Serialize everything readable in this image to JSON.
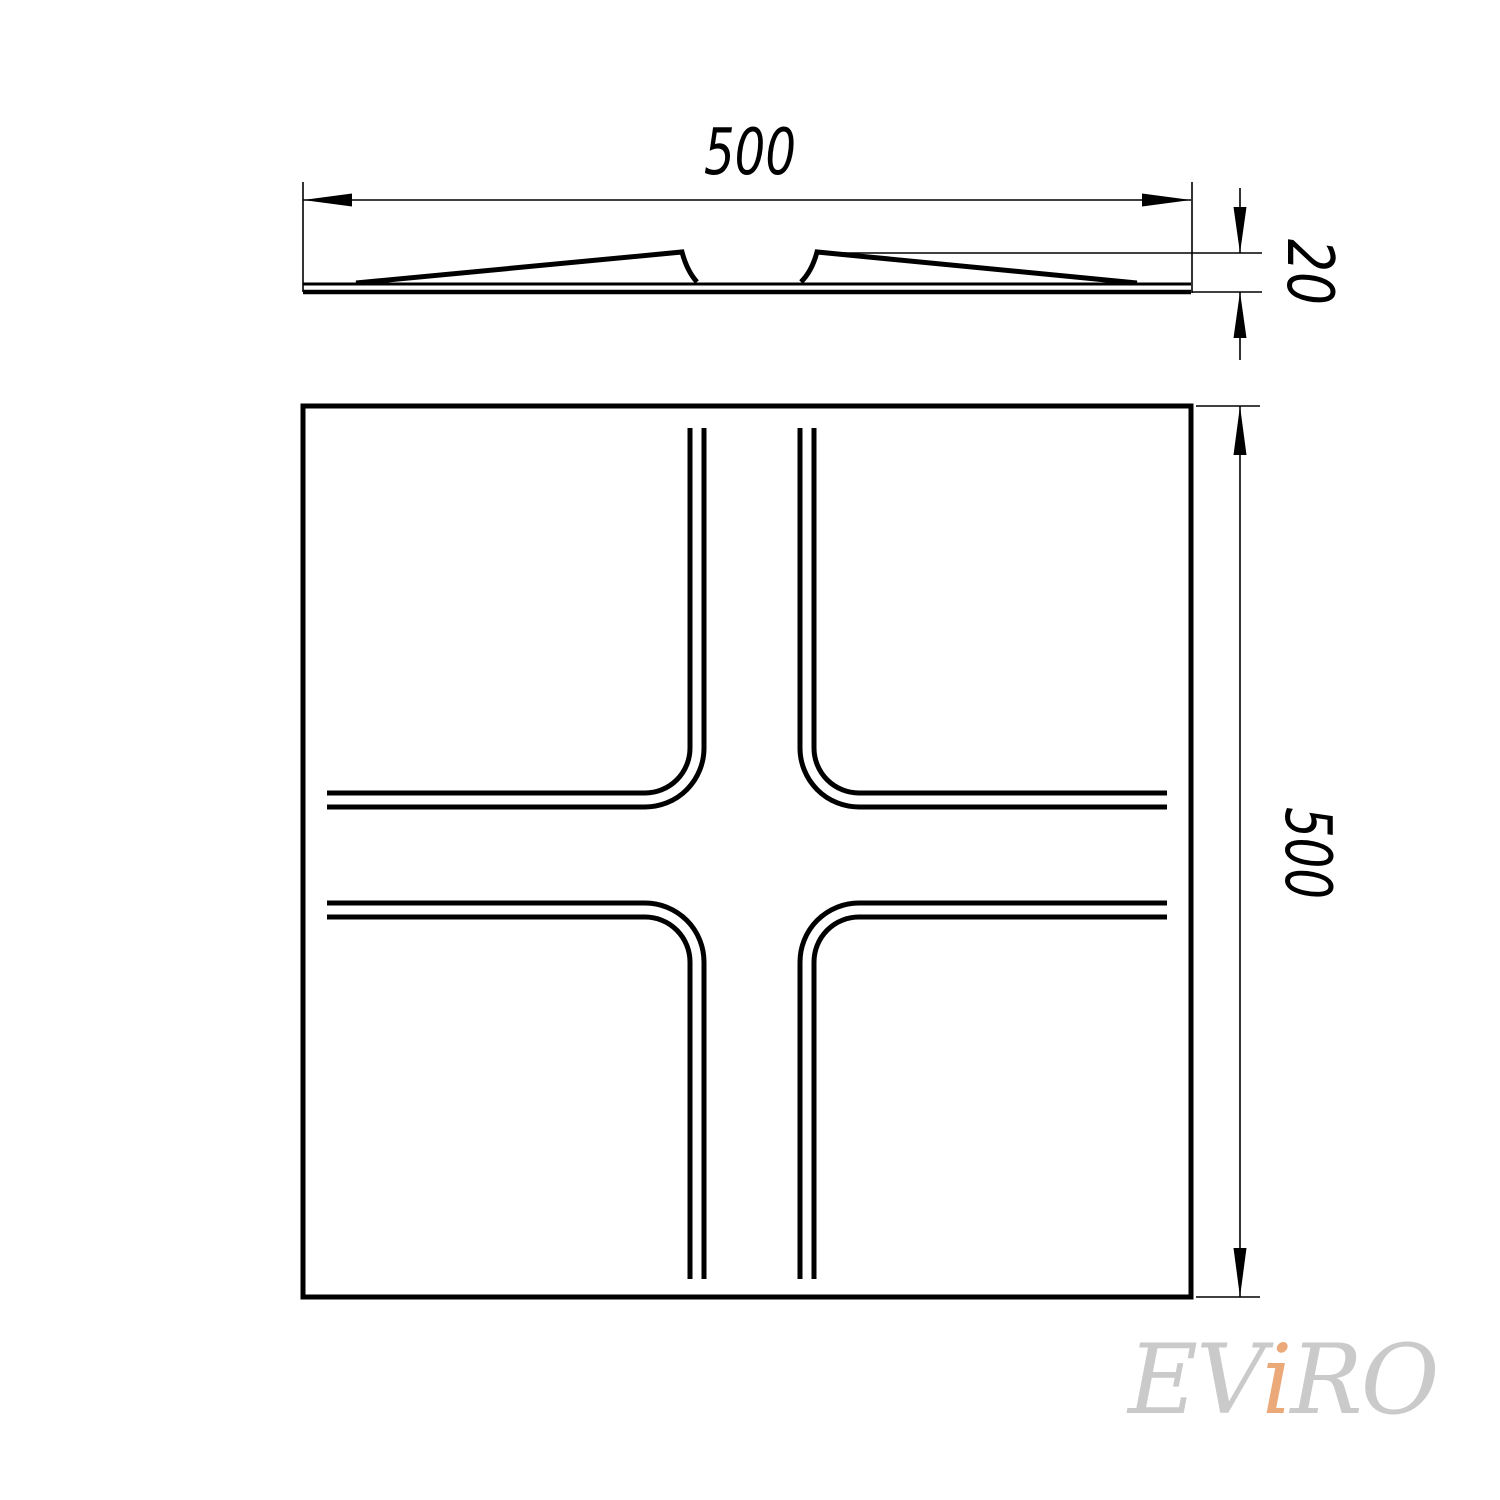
{
  "drawing": {
    "views": {
      "side_profile": {
        "description": "panel side profile with two raised wedges"
      },
      "front": {
        "description": "square panel face with rounded cross groove pattern"
      }
    }
  },
  "dimensions": {
    "top_width": "500",
    "thickness": "20",
    "side_height": "500"
  },
  "watermark": {
    "part1": "EV",
    "accent": "i",
    "part2": "RO"
  },
  "colors": {
    "line": "#000000",
    "background": "#ffffff",
    "watermark_gray": "#cacaca",
    "watermark_accent": "#eba878"
  }
}
